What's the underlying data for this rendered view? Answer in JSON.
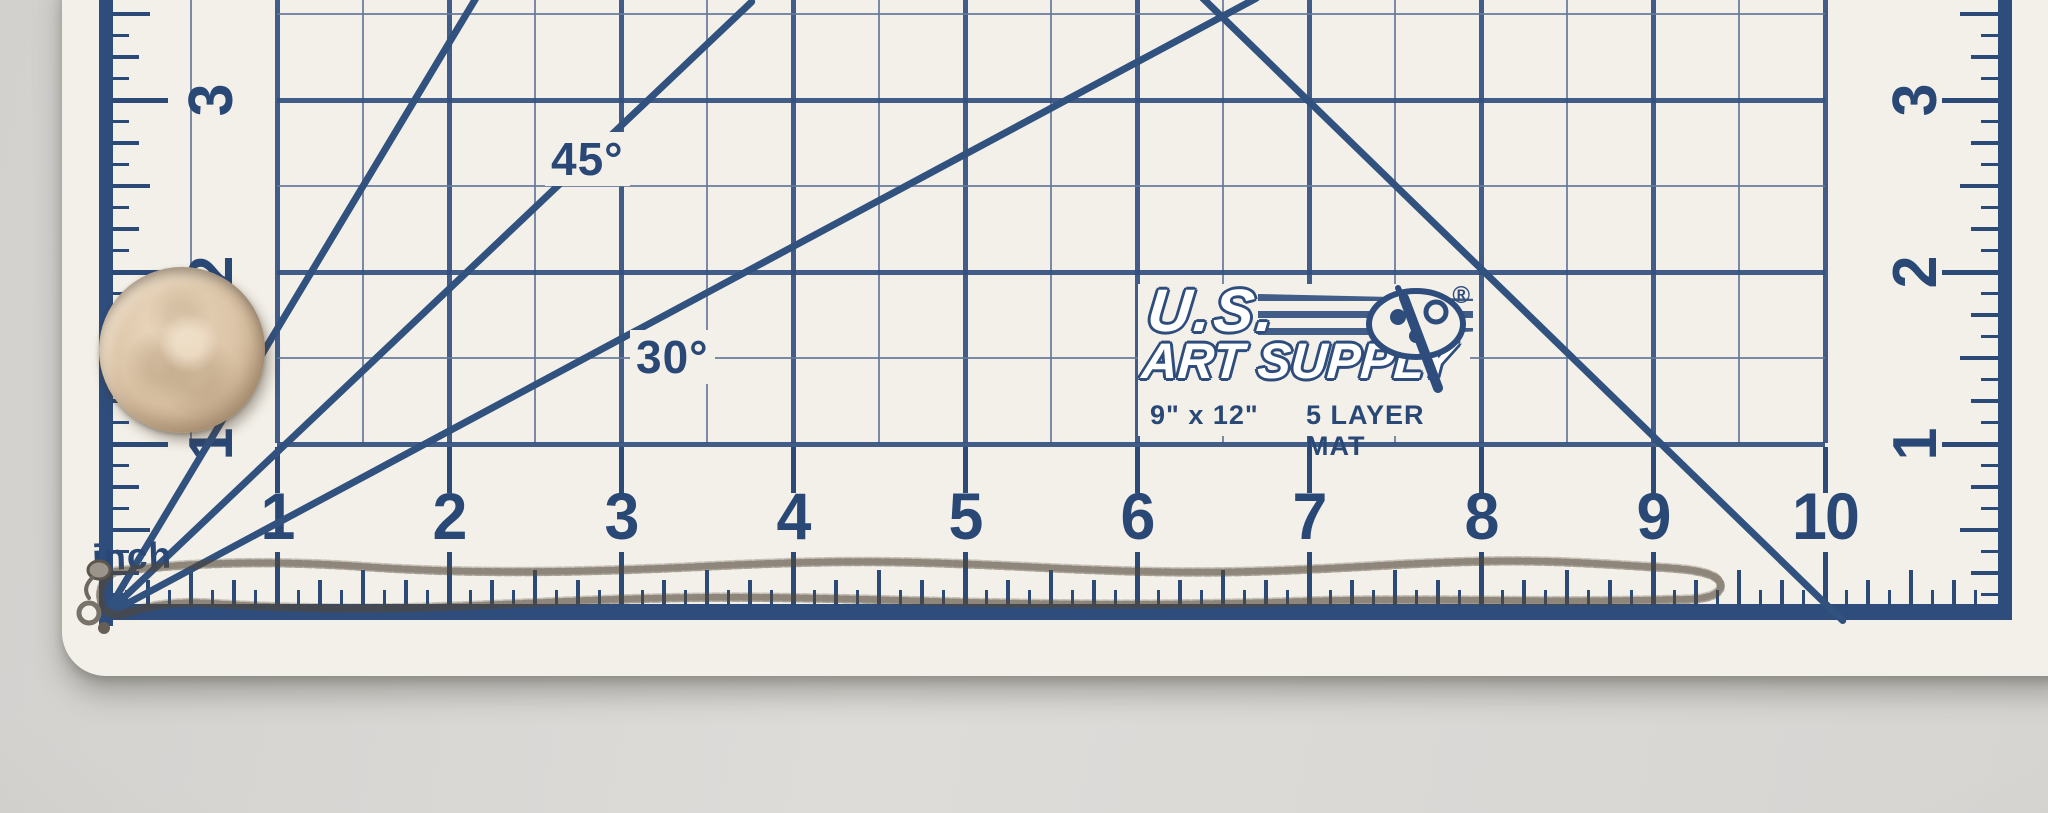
{
  "photo": {
    "subject": "thin chain necklace and quarter coin lying on a self-healing cutting mat",
    "colors": {
      "mat_surface": "#f3f0e9",
      "grid_ink": "#2e4d7c",
      "thin_grid_line": "#64789a",
      "table_background": "#d8d6d3",
      "coin_body": "#dcc5a8",
      "chain_metal": "#b5a28f"
    }
  },
  "mat": {
    "brand_line1": "U.S.",
    "brand_line2": "ART SUPPLY",
    "registered_mark": "®",
    "size_label": "9\" x 12\"",
    "layer_label": "5 LAYER MAT",
    "unit_label": "inch",
    "angle_labels": [
      "45°",
      "30°"
    ],
    "bottom_numbers": [
      "1",
      "2",
      "3",
      "4",
      "5",
      "6",
      "7",
      "8",
      "9",
      "10"
    ],
    "left_numbers": [
      "1",
      "2",
      "3"
    ],
    "right_numbers": [
      "1",
      "2",
      "3"
    ],
    "px_per_inch": 172,
    "ruler_subdivision": "eighths"
  }
}
